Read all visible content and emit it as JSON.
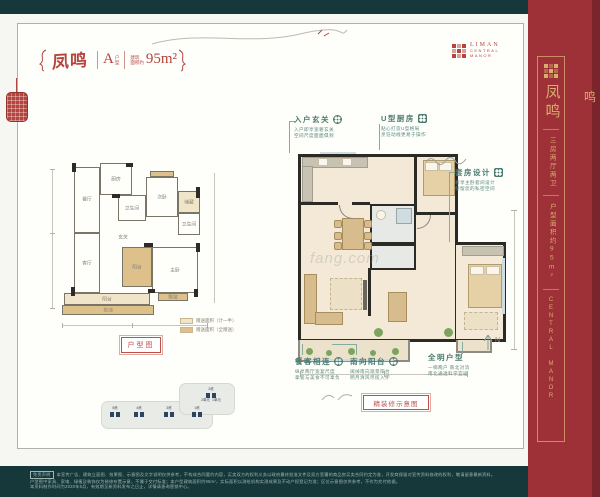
{
  "colors": {
    "band_teal": "#16383b",
    "sidebar_red": "#9e3038",
    "sidebar_red_dark": "#7c242c",
    "gold": "#d8ae6e",
    "accent_red": "#b5443e",
    "annotation_teal": "#4a7a6f"
  },
  "title_block": {
    "name": "凤鸣",
    "unit_letter": "A",
    "unit_caption_top": "户",
    "unit_caption_bottom": "型",
    "area_caption_top": "建筑",
    "area_caption_bottom": "面积约",
    "area_value": "95m²"
  },
  "logo": {
    "line1": "LIMAN",
    "line2": "CENTRAL",
    "line3": "MANOR"
  },
  "small_plan": {
    "caption": "户型图",
    "rooms": [
      "厨房",
      "餐厅",
      "卫生间",
      "次卧",
      "储藏",
      "卫生间",
      "玄关",
      "客厅",
      "阳台",
      "主卧",
      "飘窗",
      "阳台",
      "花池"
    ],
    "legend": [
      {
        "label": "赠送面积（计一半）"
      },
      {
        "label": "赠送面积（全赠送）"
      }
    ]
  },
  "key_plan": {
    "buildings": [
      "5栋",
      "4栋",
      "3栋",
      "1栋"
    ],
    "lobe_label": "2栋",
    "units": [
      "2单元",
      "1单元"
    ]
  },
  "main_plan": {
    "caption": "精装修示意图",
    "watermark": "fang.com",
    "compass_label": "N"
  },
  "annotations": [
    {
      "title": "入户玄关",
      "body1": "入户即享宽奢玄关",
      "body2": "空间尺度面面俱到"
    },
    {
      "title": "U型厨房",
      "body1": "贴心打造U型格局",
      "body2": "烹饪动线更易于操作"
    },
    {
      "title": "套房设计",
      "body1": "奢享主卧套间设计",
      "body2": "保留您的私密空间"
    },
    {
      "title": "餐客相连",
      "body1": "纵享两厅宽宴尺度",
      "body2": "挚爱与美食不可辜负"
    },
    {
      "title": "南向阳台",
      "body1": "阔绰南向观景阳台",
      "body2": "明月清风尽揽入怀"
    },
    {
      "title": "全明户型",
      "body1": "一梯两户 南北对流",
      "body2": "南北通透科学宜居"
    }
  ],
  "sidebar": {
    "project_name": "凤鸣",
    "spec": "三房两厅两卫",
    "area": "户型面积约95m²",
    "brand": "CENTRAL MANOR",
    "edge_char": "鸣"
  },
  "footer": {
    "tag": "免责声明",
    "line1": "本宣传广告、建筑立面图、效果图、示意图及文字说明仅供参考，不构成合同要约内容，买卖双方的权利义务以政府最终批准文件及双方签署的商品房买卖合同约定为准，开发商保留对宣传资料修改的权利，敬请留意最新资料。",
    "line2": "户型图中家具、家电、绿植及装饰仅为装修布置示意，不属于交付标准；本户型建筑面积约95m²，实际面积以测绘机构实测成果及不动产权登记为准；区位示意图仅供参考，不作为交付依据。",
    "line3": "本资料制作时间为2020年6月，有效期至新资料发布之日止，详情请垂询营销中心。"
  }
}
